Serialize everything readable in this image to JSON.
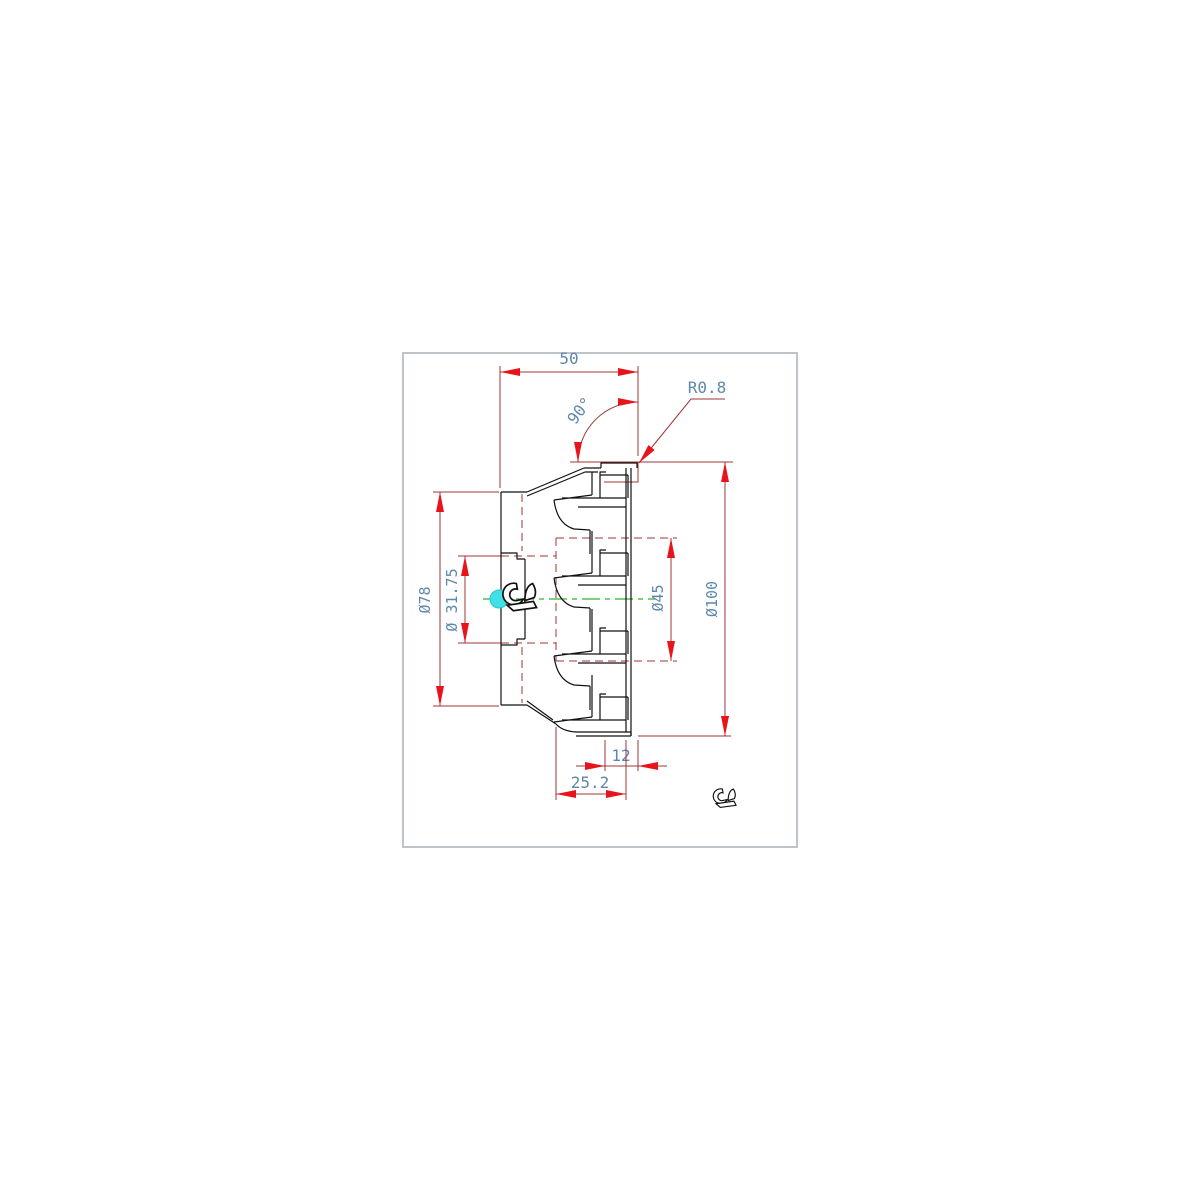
{
  "drawing": {
    "type": "cad-part-drawing-face-mill-side-section",
    "frame_color": "#a9b1b9",
    "colors": {
      "part_outline": "#111111",
      "dimension_line": "#9e3434",
      "arrow": "#e8141c",
      "dimension_text": "#5d87ad",
      "centerline": "#2db82d",
      "center_marker": "#3fe0e8"
    },
    "dims": {
      "top_width": "50",
      "lead_angle": "90°",
      "corner_radius": "R0.8",
      "back_diameter": "Ø78",
      "bore_diameter": "Ø 31.75",
      "counterbore_diameter": "Ø45",
      "cutting_diameter": "Ø100",
      "insert_offset": "12",
      "front_width": "25.2"
    },
    "icons": [
      "bird-logo-center",
      "bird-logo-corner",
      "center-marker-dot"
    ]
  }
}
